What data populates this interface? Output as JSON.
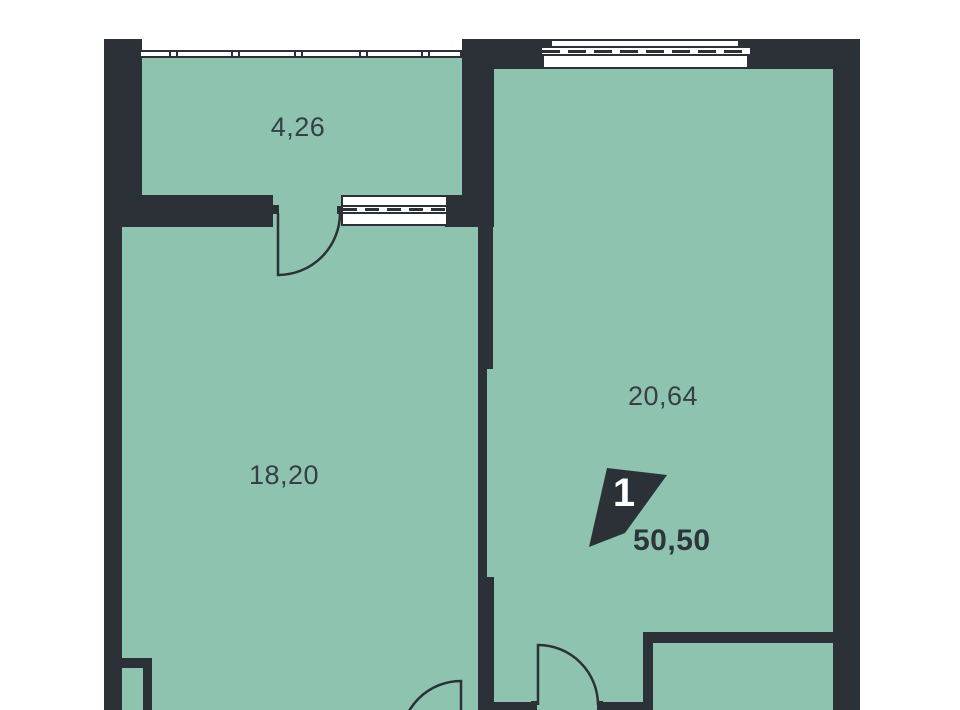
{
  "plan": {
    "type": "apartment-floor-plan",
    "rooms": [
      {
        "id": "balcony",
        "area_label": "4,26"
      },
      {
        "id": "living-room",
        "area_label": "18,20"
      },
      {
        "id": "main-room",
        "area_label": "20,64"
      }
    ],
    "badge": {
      "room_count": "1",
      "total_area": "50,50"
    },
    "colors": {
      "floor": "#8DC3AF",
      "wall": "#2B3136",
      "window": "#FFFFFF",
      "outside": "#FFFFFF",
      "label_text": "#373E46",
      "total_text": "#2D343C",
      "badge_text": "#FFFFFF"
    }
  }
}
